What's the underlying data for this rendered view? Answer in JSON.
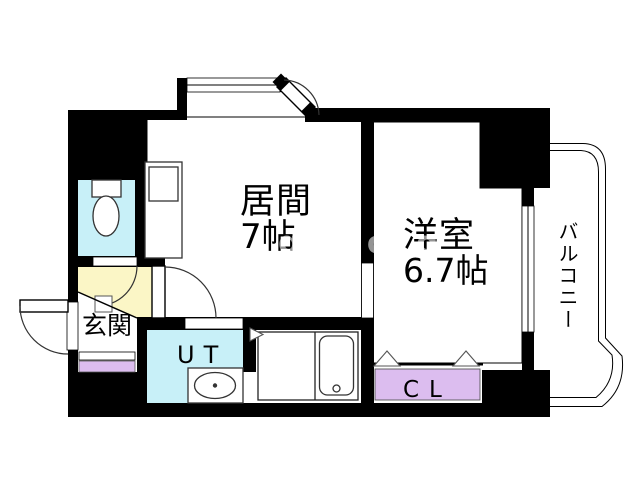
{
  "rooms": {
    "living": {
      "name": "居間",
      "size": "7帖",
      "fill": "#FBF6C6"
    },
    "western": {
      "name": "洋室",
      "size": "6.7帖",
      "fill": "#F6CA9A"
    },
    "entrance": {
      "name": "玄関",
      "fill": "#FFFFFF"
    },
    "utility": {
      "name": "UT",
      "fill": "#C8F0F8"
    },
    "closet": {
      "name": "CL",
      "fill": "#DCBDEF"
    },
    "balcony": {
      "name": "バルコニー",
      "fill": "#FFFFFF"
    },
    "toilet": {
      "fill": "#C8F0F8"
    },
    "shoe_cabinet": {
      "fill": "#DCBDEF"
    },
    "bathroom": {
      "fill": "#FFFFFF"
    }
  },
  "watermark": "gjog",
  "colors": {
    "wall": "#000000",
    "background": "#FFFFFF",
    "fixture_outline": "#333333"
  }
}
